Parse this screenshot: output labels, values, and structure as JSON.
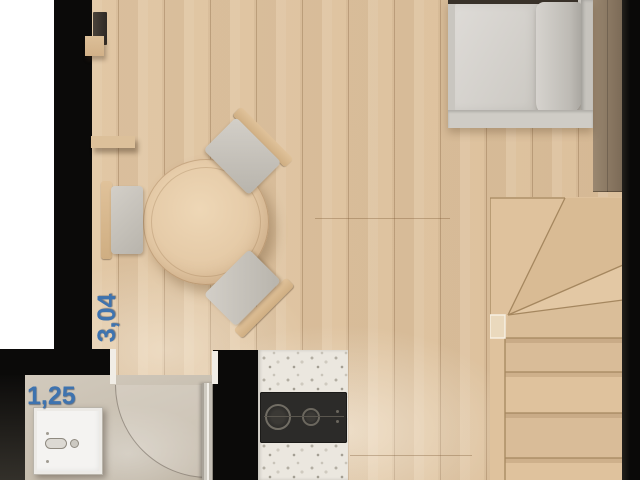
{
  "floorplan": {
    "view": "top-down apartment floor plan",
    "dimension_labels": {
      "vertical": "3,04",
      "horizontal": "1,25"
    },
    "rooms": {
      "main": "living-dining",
      "kitchen": "kitchen",
      "bathroom": "bathroom",
      "stairs": "winder-staircase"
    },
    "furniture": {
      "sofa": "sofa",
      "table": "round-dining-table",
      "chairs": "dining-chair (3)",
      "shelves": "wall-shelf (2)",
      "tv": "wall-unit",
      "sink": "bathroom-sink",
      "cooktop": "two-burner-cooktop",
      "door": "bathroom-door-swing"
    },
    "colors": {
      "dimension_text": "#3e73af",
      "walls": "#0b0a09",
      "wood_floor": "#e0c5a3",
      "stairs_wood": "#dfc29d",
      "tile_floor": "#c9c0b2",
      "counter_terrazzo": "#ebe7df",
      "cooktop_black": "#2c2b29",
      "sofa_gray": "#d2cfca",
      "outside_margin": "#ffffff"
    }
  }
}
